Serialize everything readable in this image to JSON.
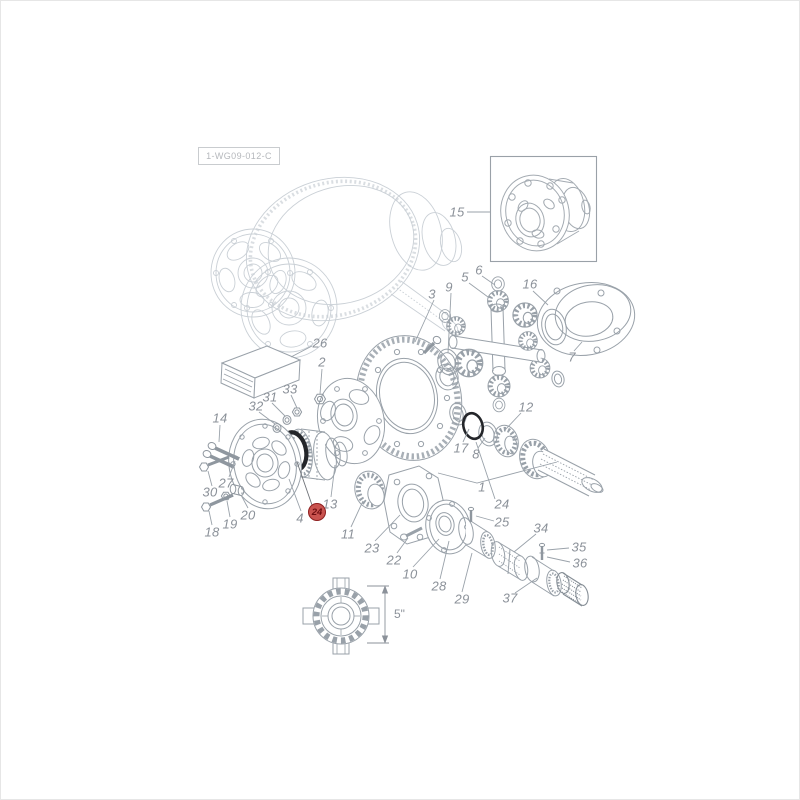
{
  "window": {
    "background": "#ffffff",
    "frame_border": "#e6e6e6"
  },
  "diagram": {
    "type": "exploded-parts-diagram",
    "subject": "differential / final drive assembly",
    "drawing_number": "1-WG09-012-C",
    "dimension_label": "5\"",
    "highlighted_part": {
      "number": "24",
      "badge_fill": "#c9534f",
      "badge_border": "#8f1f1f",
      "badge_text_color": "#6e0d10"
    },
    "colors": {
      "part_line": "#99a1a9",
      "ghost_line": "#cad0d6",
      "label_text": "#8b9199",
      "seal_highlight": "#24262a"
    },
    "inset_part_number": "15"
  },
  "part_labels": [
    {
      "ref": "15"
    },
    {
      "ref": "3"
    },
    {
      "ref": "9"
    },
    {
      "ref": "5"
    },
    {
      "ref": "6"
    },
    {
      "ref": "16"
    },
    {
      "ref": "7"
    },
    {
      "ref": "26"
    },
    {
      "ref": "2"
    },
    {
      "ref": "33"
    },
    {
      "ref": "31"
    },
    {
      "ref": "32"
    },
    {
      "ref": "14"
    },
    {
      "ref": "12"
    },
    {
      "ref": "17"
    },
    {
      "ref": "8"
    },
    {
      "ref": "1"
    },
    {
      "ref": "24"
    },
    {
      "ref": "25"
    },
    {
      "ref": "34"
    },
    {
      "ref": "35"
    },
    {
      "ref": "36"
    },
    {
      "ref": "28"
    },
    {
      "ref": "29"
    },
    {
      "ref": "37"
    },
    {
      "ref": "10"
    },
    {
      "ref": "22"
    },
    {
      "ref": "23"
    },
    {
      "ref": "11"
    },
    {
      "ref": "13"
    },
    {
      "ref": "4"
    },
    {
      "ref": "27"
    },
    {
      "ref": "30"
    },
    {
      "ref": "20"
    },
    {
      "ref": "19"
    },
    {
      "ref": "18"
    }
  ]
}
